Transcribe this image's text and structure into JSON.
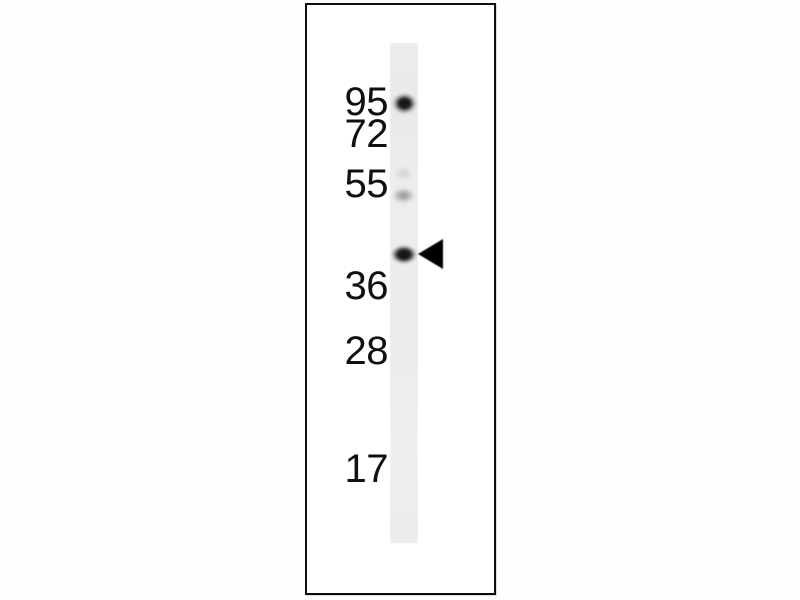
{
  "figure": {
    "kind": "western blot, single lane with molecular weight markers",
    "marker_labels": [
      "95",
      "72",
      "55",
      "36",
      "28",
      "17"
    ],
    "bands": [
      {
        "position": "aligned with 95 marker",
        "intensity": "strong"
      },
      {
        "position": "just above 55 marker",
        "intensity": "very faint"
      },
      {
        "position": "at 55 marker",
        "intensity": "faint"
      },
      {
        "position": "between 55 and 36 markers",
        "intensity": "strong",
        "annotated_with_arrow": true
      }
    ],
    "arrow": {
      "shape": "solid left-pointing triangle",
      "marks": "target band between 55 and 36 markers"
    },
    "colors": {
      "background": "#fdfdfd",
      "panel": "#ffffff",
      "panel_border": "#0d0d0d",
      "lane": "#ebebeb",
      "band_strong": "#141414",
      "band_faint": "#969696",
      "label_text": "#101010",
      "arrow": "#000000"
    }
  }
}
